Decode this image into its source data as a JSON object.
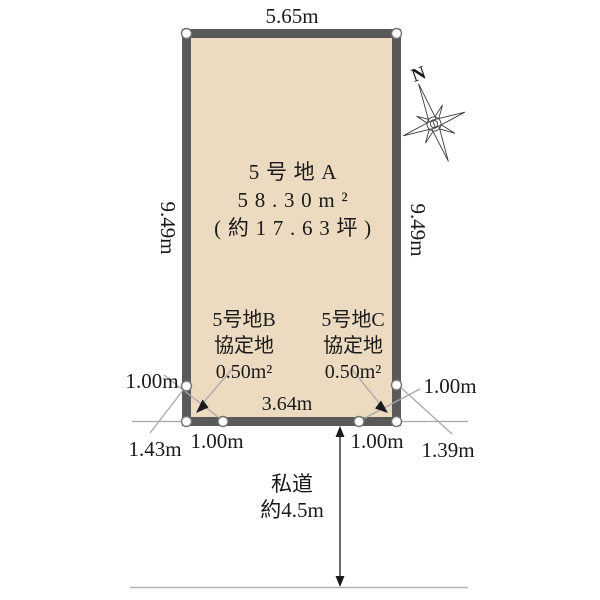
{
  "plot": {
    "top_width": "5.65m",
    "left_height": "9.49m",
    "right_height": "9.49m",
    "bottom_width": "3.64m",
    "main": {
      "name": "5号地A",
      "area": "58.30m²",
      "tsubo": "(約17.63坪)"
    },
    "corner_b": {
      "name": "5号地B",
      "category": "協定地",
      "area": "0.50m²"
    },
    "corner_c": {
      "name": "5号地C",
      "category": "協定地",
      "area": "0.50m²"
    }
  },
  "measurements": {
    "left_top": "1.00m",
    "left_diagonal": "1.43m",
    "left_bottom": "1.00m",
    "right_bottom": "1.00m",
    "right_diagonal": "1.39m",
    "right_top": "1.00m"
  },
  "road": {
    "name": "私道",
    "width": "約4.5m"
  },
  "compass": {
    "label": "N"
  },
  "colors": {
    "lot_fill": "#ecdbc0",
    "lot_border": "#595959",
    "guide_line": "#a8a8a8",
    "road_line": "#b3b3b3",
    "text": "#1a1a1a"
  }
}
